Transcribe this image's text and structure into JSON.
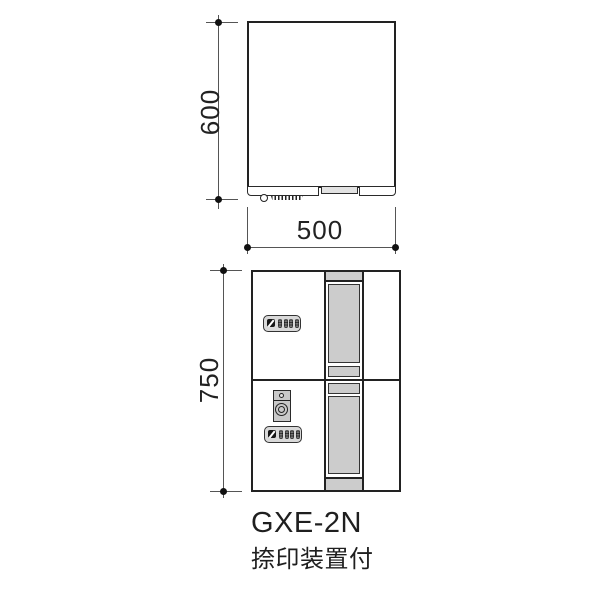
{
  "drawing": {
    "caption": {
      "model": "GXE-2N",
      "variant": "捺印装置付"
    },
    "dimensions": {
      "top_view_height": "600",
      "top_view_width": "500",
      "front_view_height": "750"
    },
    "colors": {
      "line": "#222222",
      "dimension_line": "#555555",
      "fill_gray": "#cccccc",
      "panel_gray": "#d9d9d9",
      "background": "#ffffff"
    },
    "icons": {
      "lock": "combination-lock-icon",
      "stamp": "stamp-device-icon"
    }
  }
}
